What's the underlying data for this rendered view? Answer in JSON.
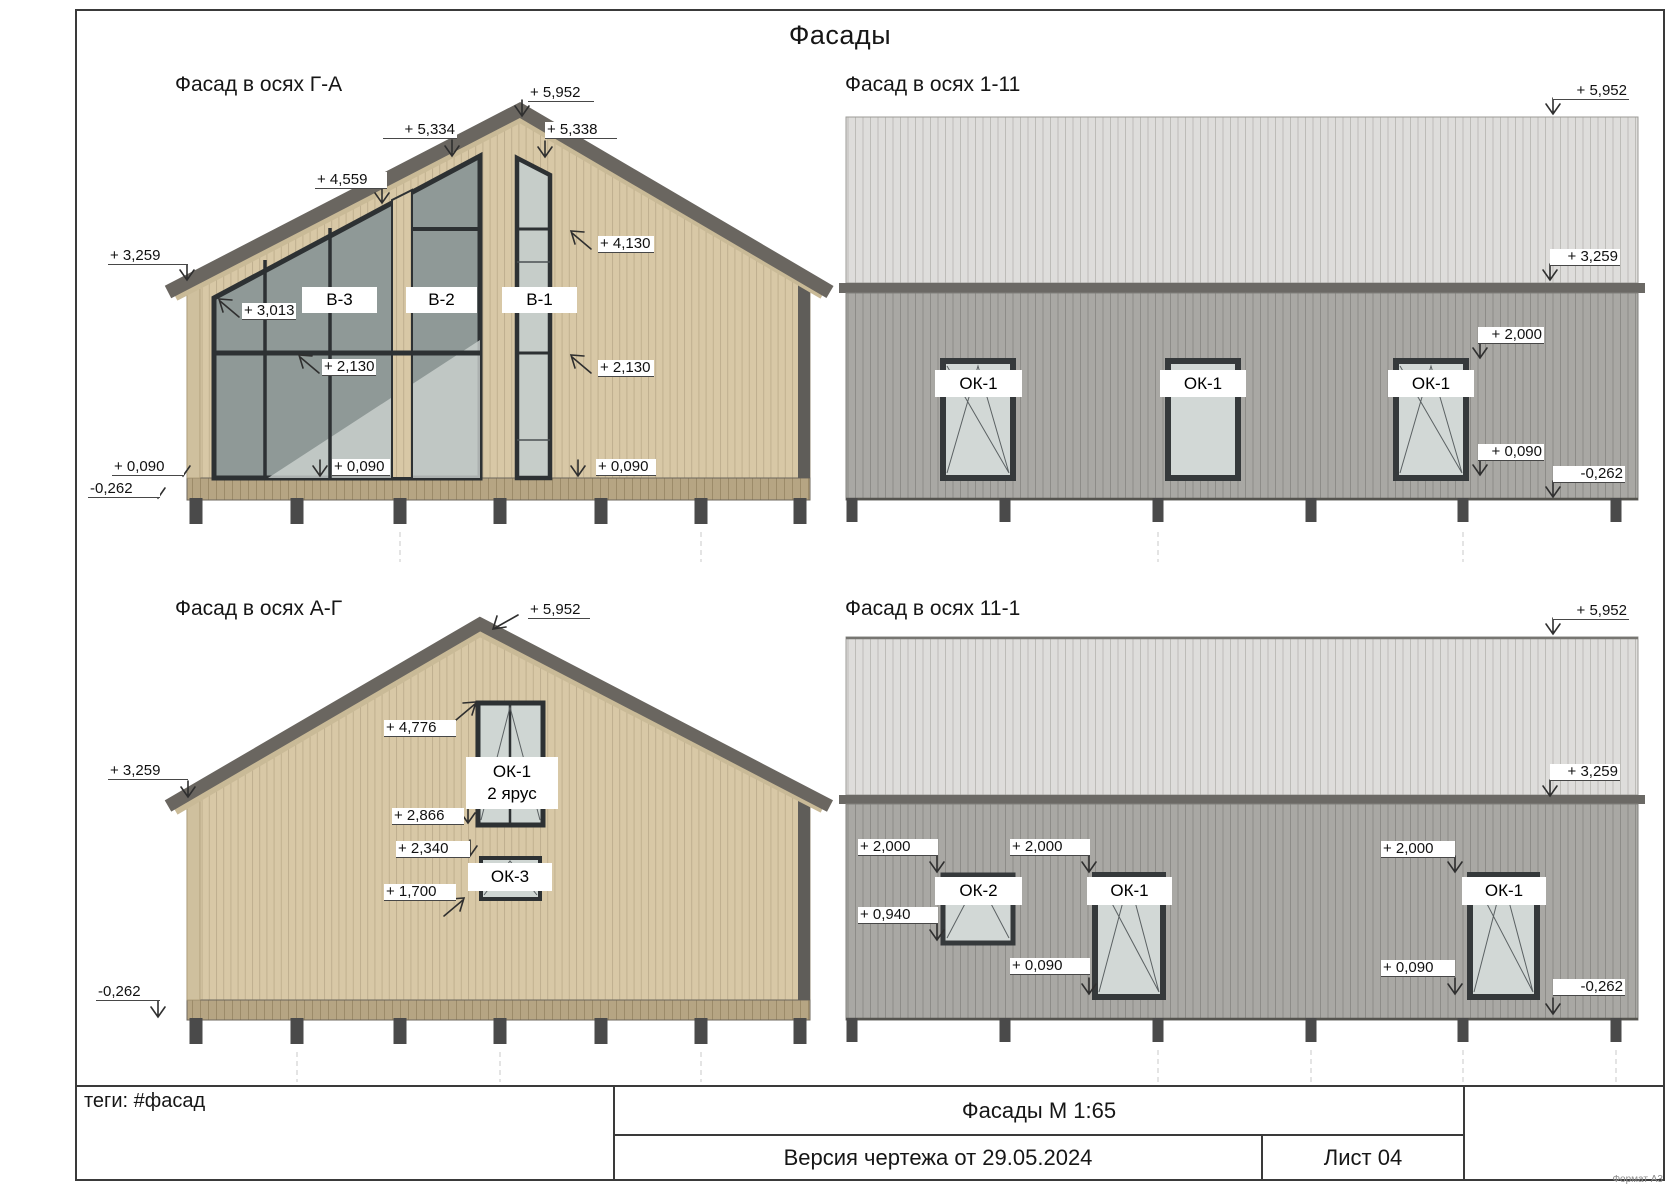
{
  "sheet": {
    "title": "Фасады",
    "tags": "теги: #фасад",
    "format_note": "Формат А3",
    "title_block": {
      "name_scale": "Фасады М 1:65",
      "version": "Версия чертежа от 29.05.2024",
      "sheet_no": "Лист 04"
    },
    "colors": {
      "wood_siding": "#d8c8a6",
      "roof_trim": "#6a6660",
      "roof_metal": "#dedddb",
      "wall_metal": "#a9a8a4",
      "glass_dark": "#8f9997",
      "glass_light": "#d2d8d6"
    }
  },
  "facades": [
    {
      "title": "Фасад в осях Г-А",
      "window_labels": [
        "В-3",
        "В-2",
        "В-1"
      ],
      "dims": {
        "peak": "+ 5,952",
        "roof_left": "+ 5,334",
        "roof_right": "+ 5,338",
        "roof_mid": "+ 4,559",
        "eave": "+ 3,259",
        "glass_top": "+ 3,013",
        "transom": "+ 2,130",
        "floor_mid": "+ 0,090",
        "floor_left": "+ 0,090",
        "base": "-0,262",
        "b1_top": "+ 4,130",
        "b1_mid": "+ 2,130",
        "b1_floor": "+ 0,090"
      }
    },
    {
      "title": "Фасад в осях 1-11",
      "window_labels": [
        "ОК-1",
        "ОК-1",
        "ОК-1"
      ],
      "dims": {
        "ridge": "+ 5,952",
        "eave": "+ 3,259",
        "win_top": "+ 2,000",
        "win_bottom": "+ 0,090",
        "base": "-0,262"
      }
    },
    {
      "title": "Фасад в осях А-Г",
      "window_labels": [
        "ОК-1",
        "2 ярус",
        "ОК-3"
      ],
      "dims": {
        "peak": "+ 5,952",
        "win2_top": "+ 4,776",
        "eave": "+ 3,259",
        "win2_bottom": "+ 2,866",
        "win3_top": "+ 2,340",
        "win3_bottom": "+ 1,700",
        "base": "-0,262"
      }
    },
    {
      "title": "Фасад в осях 11-1",
      "window_labels": [
        "ОК-2",
        "ОК-1",
        "ОК-1"
      ],
      "dims": {
        "ridge": "+ 5,952",
        "eave": "+ 3,259",
        "w1_top": "+ 2,000",
        "w2_top": "+ 2,000",
        "w3_top": "+ 2,000",
        "w1_bottom": "+ 0,940",
        "w2_bottom": "+ 0,090",
        "w3_bottom": "+ 0,090",
        "base": "-0,262"
      }
    }
  ]
}
